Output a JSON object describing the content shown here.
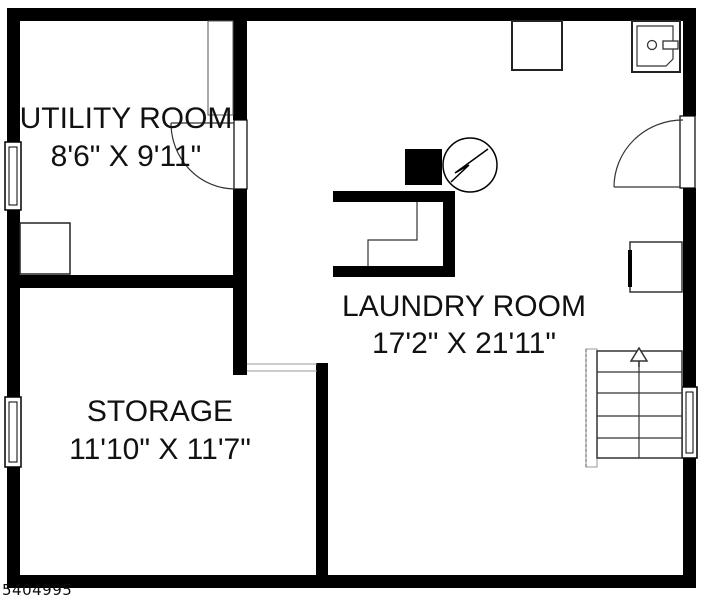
{
  "rooms": [
    {
      "name": "UTILITY ROOM",
      "dimensions": "8'6\" X 9'11\""
    },
    {
      "name": "LAUNDRY ROOM",
      "dimensions": "17'2\" X 21'11\""
    },
    {
      "name": "STORAGE",
      "dimensions": "11'10\" X 11'7\""
    }
  ],
  "watermark": {
    "number": "5404995"
  },
  "colors": {
    "wall": "#000000",
    "background": "#ffffff",
    "thin_line": "#333333",
    "light_line": "#999999"
  },
  "symbols": [
    {
      "name": "window"
    },
    {
      "name": "door-swing"
    },
    {
      "name": "stairs-up-arrow"
    },
    {
      "name": "electrical-panel"
    },
    {
      "name": "furnace"
    },
    {
      "name": "utility-sink"
    }
  ]
}
